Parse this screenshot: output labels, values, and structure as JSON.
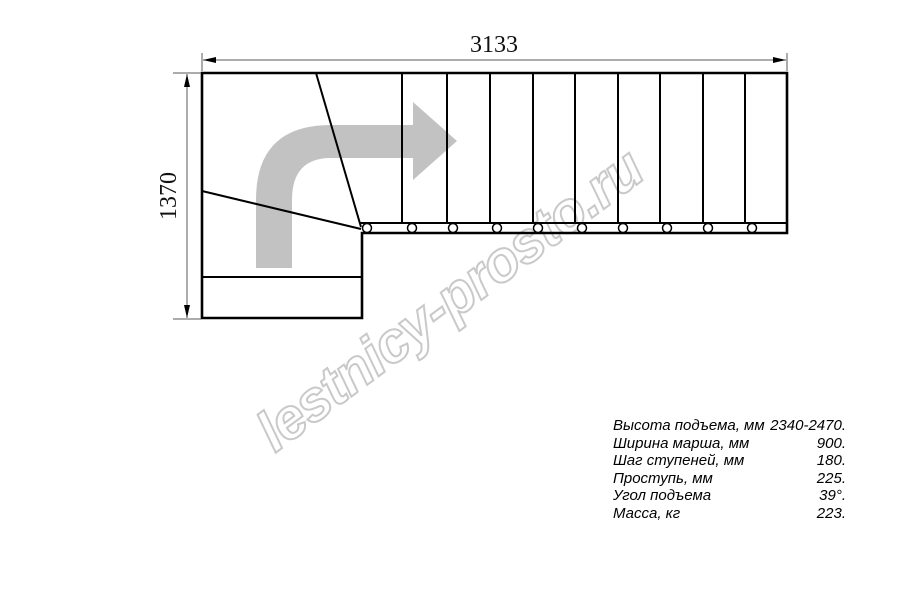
{
  "drawing": {
    "title": "staircase-plan-top-view",
    "top_dimension_mm": "3133",
    "left_dimension_mm": "1370",
    "watermark": "lestnicy-prosto.ru",
    "straight_treads": 10,
    "winder_treads": 3,
    "baluster_count": 10
  },
  "specs": {
    "rows": [
      {
        "label": "Высота подъема, мм",
        "value": "2340-2470."
      },
      {
        "label": "Ширина марша, мм",
        "value": "900."
      },
      {
        "label": "Шаг ступеней, мм",
        "value": "180."
      },
      {
        "label": "Проступь, мм",
        "value": "225."
      },
      {
        "label": "Угол подъема",
        "value": "39°."
      },
      {
        "label": "Масса, кг",
        "value": "223."
      }
    ]
  },
  "colors": {
    "line": "#000000",
    "dimension_line": "#5a5a5a",
    "arrow_fill": "#c2c2c2",
    "watermark_outline": "#c9c9c9",
    "background": "#ffffff"
  }
}
